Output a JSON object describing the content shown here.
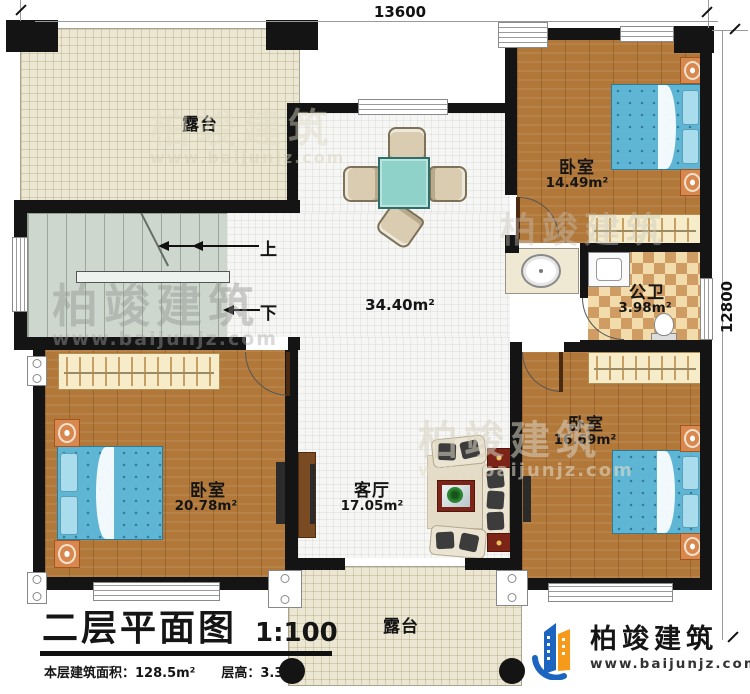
{
  "dimensions": {
    "top": "13600",
    "right": "12800"
  },
  "stairs": {
    "up": "上",
    "down": "下"
  },
  "rooms": {
    "terrace_top": {
      "name": "露台"
    },
    "bedroom_top_right": {
      "name": "卧室",
      "area": "14.49m²"
    },
    "hall": {
      "area": "34.40m²"
    },
    "bathroom": {
      "name": "公卫",
      "area": "3.98m²"
    },
    "bedroom_bottom_right": {
      "name": "卧室",
      "area": "16.69m²"
    },
    "bedroom_bottom_left": {
      "name": "卧室",
      "area": "20.78m²"
    },
    "living_room": {
      "name": "客厅",
      "area": "17.05m²"
    },
    "terrace_bottom": {
      "name": "露台"
    }
  },
  "title_block": {
    "title": "二层平面图",
    "scale": "1:100",
    "floor_area": "本层建筑面积：128.5m²",
    "floor_height": "层高：3.3m"
  },
  "branding": {
    "company": "柏竣建筑",
    "website": "www.baijunjz.com"
  },
  "watermark": {
    "company": "柏竣建筑",
    "website": "www.baijunjz.com"
  },
  "colors": {
    "wall": "#141414",
    "wood": "#b1783a",
    "tile": "#f6f6f4",
    "terrace": "#ece7d3",
    "stairs": "#cdd7cd",
    "bath_tile_a": "#f2dcab",
    "bath_tile_b": "#cf9d63",
    "bed": "#5fb6d4",
    "logo_blue": "#1b64c0",
    "logo_orange": "#f59a1a"
  }
}
